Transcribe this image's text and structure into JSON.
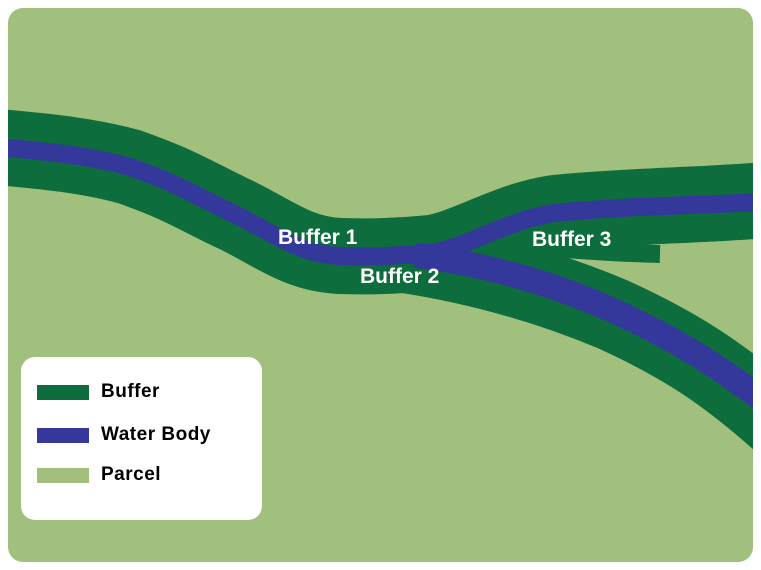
{
  "figure": {
    "description": "Buffer zones around a branching water body within a parcel"
  },
  "colors": {
    "background": "#ffffff",
    "parcel": "#a1c07e",
    "buffer": "#0d6d3d",
    "water": "#34389b",
    "map_label_text": "#ffffff",
    "legend_text": "#000000",
    "legend_background": "#ffffff"
  },
  "map": {
    "labels": [
      {
        "text": "Buffer 1"
      },
      {
        "text": "Buffer 2"
      },
      {
        "text": "Buffer 3"
      }
    ]
  },
  "legend": {
    "items": [
      {
        "label": "Buffer",
        "color": "#0d6d3d"
      },
      {
        "label": "Water Body",
        "color": "#34389b"
      },
      {
        "label": "Parcel",
        "color": "#a1c07e"
      }
    ]
  }
}
